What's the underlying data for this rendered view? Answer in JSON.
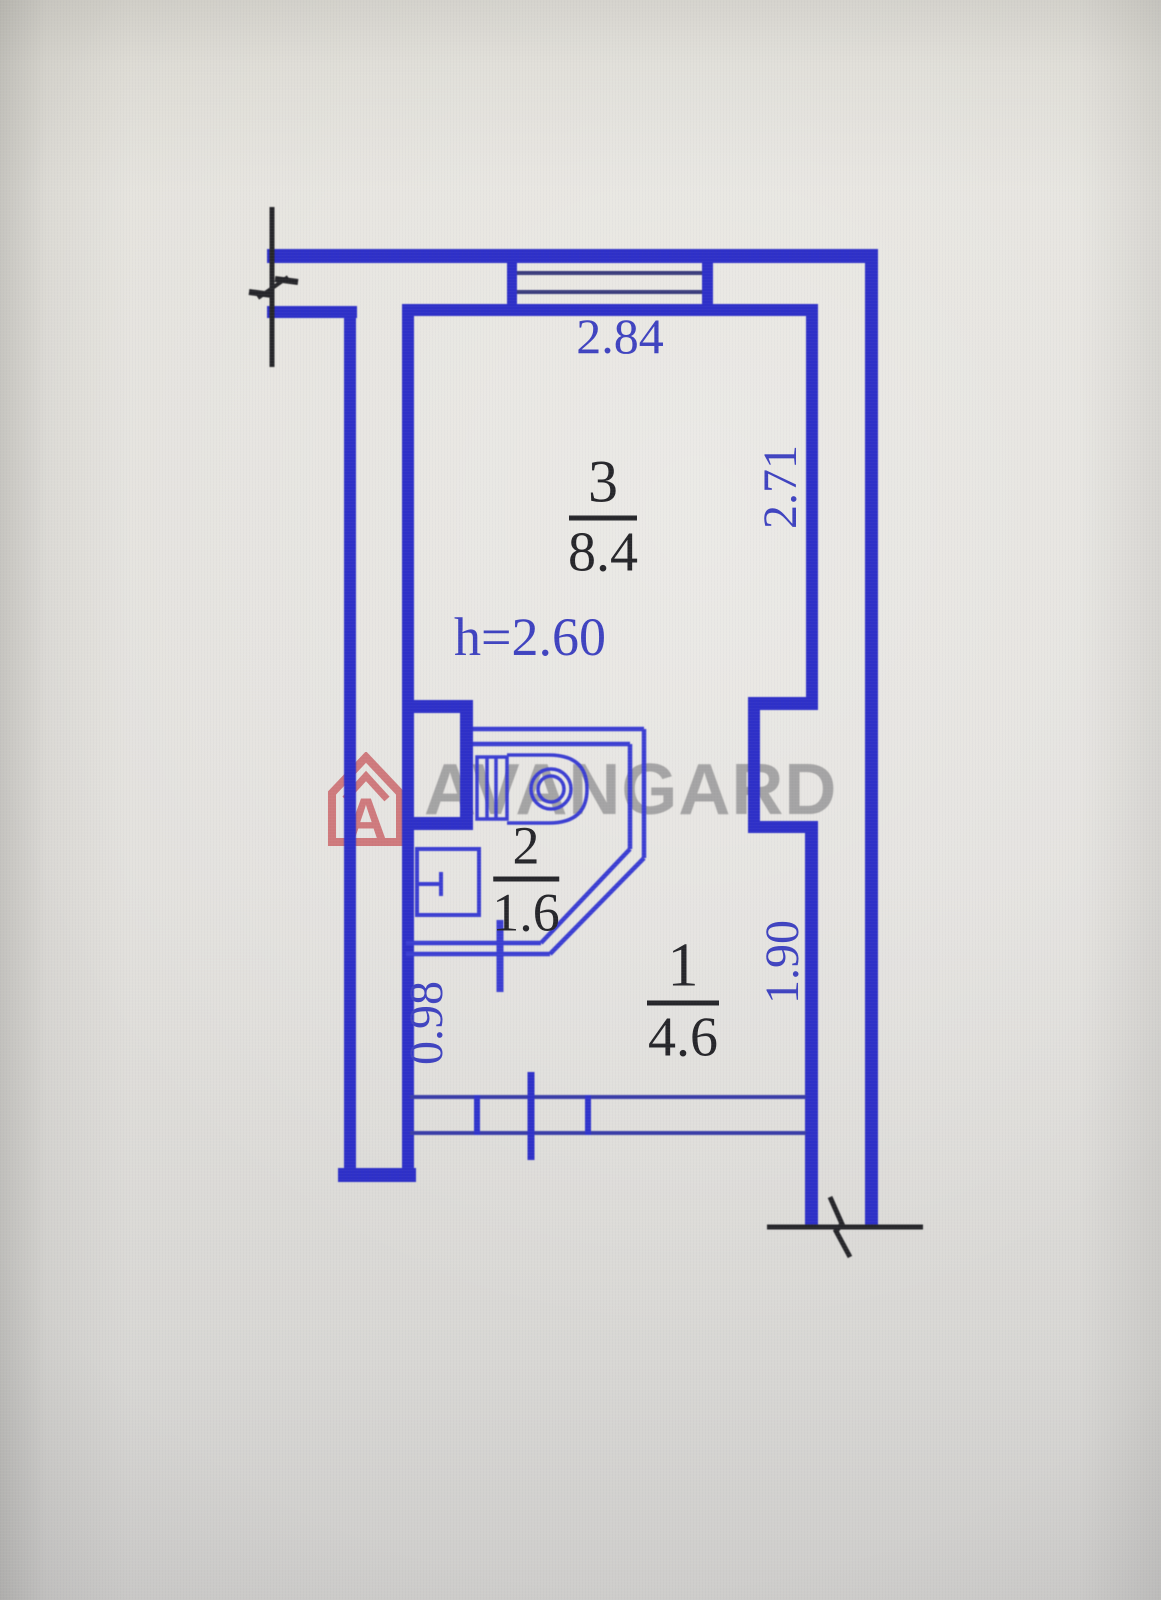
{
  "watermark": {
    "brand": "AVANGARD",
    "logo_letter": "A"
  },
  "plan": {
    "rooms": [
      {
        "number": "3",
        "area": "8.4",
        "height_note": "h=2.60"
      },
      {
        "number": "2",
        "area": "1.6"
      },
      {
        "number": "1",
        "area": "4.6"
      }
    ],
    "dimensions": {
      "room3_width": "2.84",
      "room3_depth": "2.71",
      "corridor_width": "0.98",
      "hall_depth": "1.90"
    }
  },
  "colors": {
    "wall_blue": "#2e30c8",
    "partition_blue": "#3b3ed2",
    "window_line_navy": "#3a3c7c",
    "dimension_text_blue": "#3f43c0",
    "label_black": "#26262a",
    "logo_red": "#c4444a",
    "watermark_gray": "#6a6a6c"
  }
}
